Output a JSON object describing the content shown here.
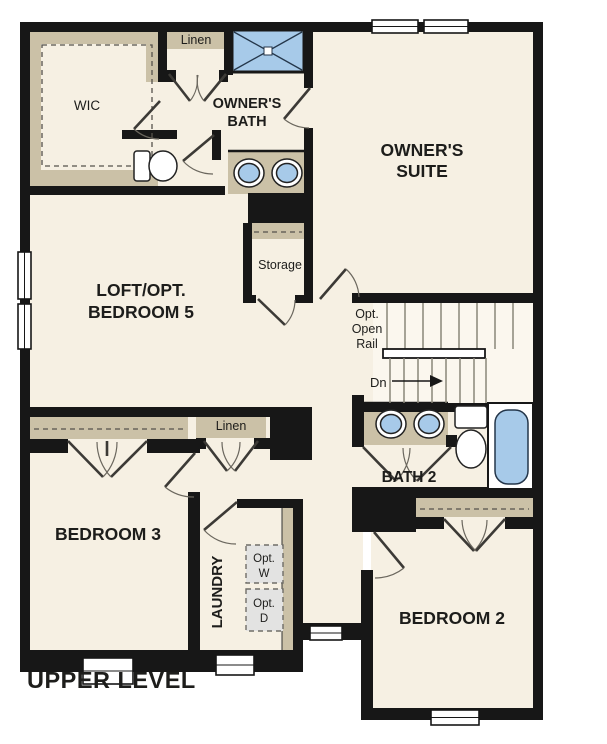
{
  "title": "UPPER LEVEL",
  "colors": {
    "floor": "#f6f0e3",
    "wall": "#171717",
    "tan": "#cbc1a7",
    "blue": "#a7cae9",
    "graybox": "#e3e3e2",
    "stair": "#8a8779",
    "paper": "#ffffff",
    "ink": "#1d1d1b"
  },
  "rooms": {
    "wic": "WIC",
    "linen1": "Linen",
    "owners_bath_l1": "OWNER'S",
    "owners_bath_l2": "BATH",
    "owners_suite_l1": "OWNER'S",
    "owners_suite_l2": "SUITE",
    "loft_l1": "LOFT/OPT.",
    "loft_l2": "BEDROOM 5",
    "storage": "Storage",
    "opt_rail_l1": "Opt.",
    "opt_rail_l2": "Open",
    "opt_rail_l3": "Rail",
    "dn": "Dn",
    "bath2": "BATH 2",
    "linen2": "Linen",
    "bedroom3": "BEDROOM 3",
    "laundry": "LAUNDRY",
    "opt_w_l1": "Opt.",
    "opt_w_l2": "W",
    "opt_d_l1": "Opt.",
    "opt_d_l2": "D",
    "bedroom2": "BEDROOM 2"
  },
  "fixtures": [
    "shower",
    "owners-bath-double-sinks",
    "owners-toilet",
    "bath2-double-sinks",
    "bath2-toilet",
    "bathtub",
    "optional-washer",
    "optional-dryer",
    "staircase-down"
  ]
}
